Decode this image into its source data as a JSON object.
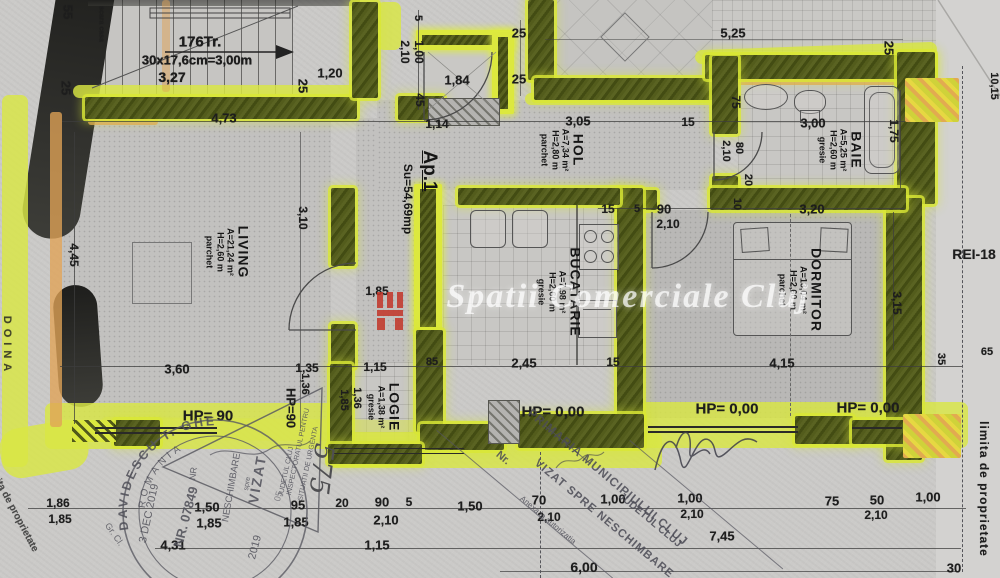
{
  "plan_title": "Ap.1 apartment floor plan",
  "apartment": {
    "label": "Ap.1",
    "area": "Su=54,69mp"
  },
  "rooms": [
    {
      "id": "living",
      "name": "LIVING",
      "area": "A=21,24 m²",
      "height": "H=2,60 m",
      "floor": "parchet",
      "x": 228,
      "y": 252
    },
    {
      "id": "hol",
      "name": "HOL",
      "area": "A=7,34 m²",
      "height": "H=2,80 m",
      "floor": "parchet",
      "x": 563,
      "y": 150
    },
    {
      "id": "bucatarie",
      "name": "BUCATARIE",
      "area": "A=7,98 m²",
      "height": "H=2,60 m",
      "floor": "gresie",
      "x": 560,
      "y": 292
    },
    {
      "id": "baie",
      "name": "BAIE",
      "area": "A=5,25 m²",
      "height": "H=2,60 m",
      "floor": "gresie",
      "x": 841,
      "y": 150
    },
    {
      "id": "dormitor",
      "name": "DORMITOR",
      "area": "A=13,04 m²",
      "height": "H=2,60 m",
      "floor": "parchet",
      "x": 801,
      "y": 290
    },
    {
      "id": "logie",
      "name": "LOGIE",
      "area": "A=1,38 m²",
      "height": "",
      "floor": "gresie",
      "x": 384,
      "y": 407
    }
  ],
  "stairs": {
    "treads": "176Tr.",
    "spec": "30x17,6cm=3,00m",
    "width": "3,27",
    "side": "scara casa"
  },
  "watermark": {
    "text": "Spatii Comerciale Cluj"
  },
  "edges": {
    "right": "limita de proprietate",
    "left": "limita de proprietate",
    "arc_left": "DOINA",
    "handwritten": "575",
    "rei": "REI-18"
  },
  "stamps": {
    "round": {
      "arc": "DAVIDESCU T. GHE",
      "inner_arc": "ROMANIA",
      "number": "NR. 07849",
      "date": "3 DEC 2019",
      "grade": "Gr. Cl."
    },
    "isu": {
      "l1": "INSPECTORATUL PENTRU",
      "l2": "SITUATII DE URGENTA",
      "l3": "JUDETUL CLUJ",
      "vizat": "VIZAT",
      "spre": "spre",
      "neschimbare": "NESCHIMBARE",
      "nr": "NR",
      "year": "2019",
      "day": "05"
    },
    "primaria": {
      "l1": "PRIMARIA MUNICIPIULUI CLUJ",
      "l2": "VIZAT SPRE NESCHIMBARE",
      "l3": "Anexa la autorizatia",
      "l4": "JUDETUL CLUJ",
      "nr": "Nr."
    }
  },
  "labels": [
    {
      "t": "55",
      "x": 68,
      "y": 12,
      "r": 90,
      "s": 13
    },
    {
      "t": "25",
      "x": 66,
      "y": 88,
      "r": 90,
      "s": 13
    },
    {
      "t": "176Tr.",
      "x": 200,
      "y": 42,
      "r": 0,
      "s": 15
    },
    {
      "t": "30x17,6cm=3,00m",
      "x": 197,
      "y": 60,
      "r": 0,
      "s": 13
    },
    {
      "t": "3,27",
      "x": 172,
      "y": 77,
      "r": 0,
      "s": 14
    },
    {
      "t": "1,20",
      "x": 330,
      "y": 73,
      "r": 0,
      "s": 13
    },
    {
      "t": "25",
      "x": 303,
      "y": 86,
      "r": 90,
      "s": 13
    },
    {
      "t": "4,73",
      "x": 224,
      "y": 118,
      "r": 0,
      "s": 13
    },
    {
      "t": "5",
      "x": 418,
      "y": 18,
      "r": 90,
      "s": 11
    },
    {
      "t": "2,10",
      "x": 405,
      "y": 52,
      "r": 90,
      "s": 12
    },
    {
      "t": "1,00",
      "x": 419,
      "y": 52,
      "r": 90,
      "s": 12
    },
    {
      "t": "25",
      "x": 519,
      "y": 33,
      "r": 0,
      "s": 13
    },
    {
      "t": "1,84",
      "x": 457,
      "y": 80,
      "r": 0,
      "s": 13
    },
    {
      "t": "25",
      "x": 519,
      "y": 79,
      "r": 0,
      "s": 13
    },
    {
      "t": "45",
      "x": 420,
      "y": 100,
      "r": 90,
      "s": 12
    },
    {
      "t": "1,14",
      "x": 437,
      "y": 124,
      "r": 0,
      "s": 12
    },
    {
      "t": "3,05",
      "x": 578,
      "y": 121,
      "r": 0,
      "s": 13
    },
    {
      "t": "15",
      "x": 688,
      "y": 122,
      "r": 0,
      "s": 12
    },
    {
      "t": "5,25",
      "x": 733,
      "y": 33,
      "r": 0,
      "s": 13
    },
    {
      "t": "25",
      "x": 889,
      "y": 48,
      "r": 90,
      "s": 13
    },
    {
      "t": "75",
      "x": 736,
      "y": 102,
      "r": 90,
      "s": 12
    },
    {
      "t": "3,00",
      "x": 813,
      "y": 123,
      "r": 0,
      "s": 13
    },
    {
      "t": "1,75",
      "x": 894,
      "y": 131,
      "r": 90,
      "s": 12
    },
    {
      "t": "80",
      "x": 739,
      "y": 148,
      "r": 90,
      "s": 11
    },
    {
      "t": "2,10",
      "x": 726,
      "y": 151,
      "r": 90,
      "s": 11
    },
    {
      "t": "20",
      "x": 748,
      "y": 180,
      "r": 90,
      "s": 11
    },
    {
      "t": "10,15",
      "x": 994,
      "y": 86,
      "r": 90,
      "s": 11
    },
    {
      "t": "3,20",
      "x": 812,
      "y": 209,
      "r": 0,
      "s": 13
    },
    {
      "t": "REI-18",
      "x": 974,
      "y": 254,
      "r": 0,
      "s": 14,
      "n": "rei-label"
    },
    {
      "t": "15",
      "x": 608,
      "y": 209,
      "r": 0,
      "s": 12
    },
    {
      "t": "5",
      "x": 637,
      "y": 209,
      "r": 0,
      "s": 11
    },
    {
      "t": "90",
      "x": 664,
      "y": 209,
      "r": 0,
      "s": 13
    },
    {
      "t": "2,10",
      "x": 668,
      "y": 224,
      "r": 0,
      "s": 12
    },
    {
      "t": "10",
      "x": 737,
      "y": 204,
      "r": 90,
      "s": 11
    },
    {
      "t": "1,85",
      "x": 377,
      "y": 291,
      "r": 0,
      "s": 12
    },
    {
      "t": "2,45",
      "x": 524,
      "y": 363,
      "r": 0,
      "s": 13
    },
    {
      "t": "15",
      "x": 613,
      "y": 362,
      "r": 0,
      "s": 12
    },
    {
      "t": "3,10",
      "x": 303,
      "y": 218,
      "r": 90,
      "s": 12
    },
    {
      "t": "4,45",
      "x": 74,
      "y": 255,
      "r": 90,
      "s": 12
    },
    {
      "t": "3,60",
      "x": 177,
      "y": 369,
      "r": 0,
      "s": 13
    },
    {
      "t": "3,15",
      "x": 897,
      "y": 303,
      "r": 90,
      "s": 12
    },
    {
      "t": "4,15",
      "x": 782,
      "y": 363,
      "r": 0,
      "s": 13
    },
    {
      "t": "35",
      "x": 941,
      "y": 359,
      "r": 90,
      "s": 11
    },
    {
      "t": "65",
      "x": 987,
      "y": 352,
      "r": 0,
      "s": 11
    },
    {
      "t": "1,35",
      "x": 307,
      "y": 368,
      "r": 0,
      "s": 12
    },
    {
      "t": "1,15",
      "x": 375,
      "y": 367,
      "r": 0,
      "s": 12
    },
    {
      "t": "85",
      "x": 432,
      "y": 362,
      "r": 0,
      "s": 11
    },
    {
      "t": "1,36",
      "x": 305,
      "y": 384,
      "r": 90,
      "s": 11
    },
    {
      "t": "HP=90",
      "x": 291,
      "y": 408,
      "r": 90,
      "s": 13,
      "n": "hp-label"
    },
    {
      "t": "1,85",
      "x": 344,
      "y": 400,
      "r": 90,
      "s": 11
    },
    {
      "t": "1,36",
      "x": 357,
      "y": 398,
      "r": 90,
      "s": 11
    },
    {
      "t": "HP= 90",
      "x": 208,
      "y": 416,
      "r": 0,
      "s": 15,
      "n": "hp-label"
    },
    {
      "t": "HP= 0,00",
      "x": 553,
      "y": 412,
      "r": 0,
      "s": 15,
      "n": "hp-label"
    },
    {
      "t": "HP= 0,00",
      "x": 727,
      "y": 409,
      "r": 0,
      "s": 15,
      "n": "hp-label"
    },
    {
      "t": "HP= 0,00",
      "x": 868,
      "y": 408,
      "r": 0,
      "s": 15,
      "n": "hp-label"
    },
    {
      "t": "1,86",
      "x": 58,
      "y": 503,
      "r": 0,
      "s": 12
    },
    {
      "t": "1,85",
      "x": 60,
      "y": 519,
      "r": 0,
      "s": 12
    },
    {
      "t": "1,50",
      "x": 207,
      "y": 507,
      "r": 0,
      "s": 13
    },
    {
      "t": "1,85",
      "x": 209,
      "y": 523,
      "r": 0,
      "s": 13
    },
    {
      "t": "95",
      "x": 298,
      "y": 505,
      "r": 0,
      "s": 13
    },
    {
      "t": "1,85",
      "x": 296,
      "y": 522,
      "r": 0,
      "s": 13
    },
    {
      "t": "20",
      "x": 342,
      "y": 503,
      "r": 0,
      "s": 12
    },
    {
      "t": "90",
      "x": 382,
      "y": 502,
      "r": 0,
      "s": 13
    },
    {
      "t": "5",
      "x": 409,
      "y": 502,
      "r": 0,
      "s": 12
    },
    {
      "t": "2,10",
      "x": 386,
      "y": 520,
      "r": 0,
      "s": 13
    },
    {
      "t": "4,31",
      "x": 173,
      "y": 545,
      "r": 0,
      "s": 13
    },
    {
      "t": "1,15",
      "x": 377,
      "y": 545,
      "r": 0,
      "s": 13
    },
    {
      "t": "1,50",
      "x": 470,
      "y": 506,
      "r": 0,
      "s": 13
    },
    {
      "t": "70",
      "x": 539,
      "y": 500,
      "r": 0,
      "s": 13
    },
    {
      "t": "2,10",
      "x": 549,
      "y": 517,
      "r": 0,
      "s": 12
    },
    {
      "t": "1,00",
      "x": 613,
      "y": 499,
      "r": 0,
      "s": 13
    },
    {
      "t": "1,00",
      "x": 690,
      "y": 498,
      "r": 0,
      "s": 13
    },
    {
      "t": "2,10",
      "x": 692,
      "y": 514,
      "r": 0,
      "s": 12
    },
    {
      "t": "7,45",
      "x": 722,
      "y": 536,
      "r": 0,
      "s": 13
    },
    {
      "t": "6,00",
      "x": 584,
      "y": 567,
      "r": 0,
      "s": 14
    },
    {
      "t": "1,00",
      "x": 928,
      "y": 497,
      "r": 0,
      "s": 13
    },
    {
      "t": "75",
      "x": 832,
      "y": 501,
      "r": 0,
      "s": 13
    },
    {
      "t": "50",
      "x": 877,
      "y": 500,
      "r": 0,
      "s": 13
    },
    {
      "t": "2,10",
      "x": 876,
      "y": 515,
      "r": 0,
      "s": 12
    },
    {
      "t": "30",
      "x": 954,
      "y": 568,
      "r": 0,
      "s": 13
    }
  ]
}
